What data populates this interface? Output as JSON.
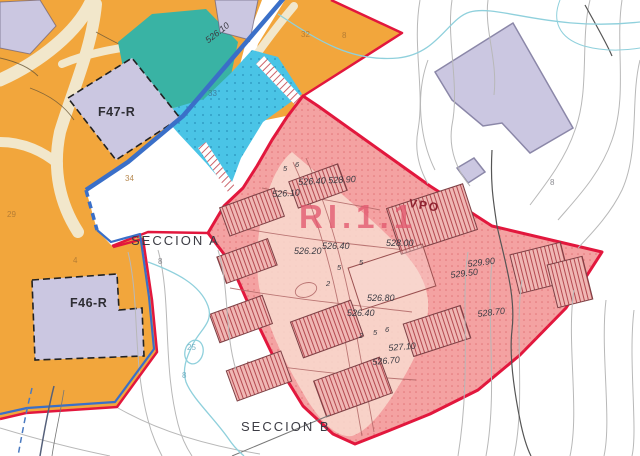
{
  "labels": {
    "f47": "F47-R",
    "f46": "F46-R",
    "sector": "RI.1.1",
    "vpo": "VPO",
    "seccion_a": "SECCION A",
    "seccion_b": "SECCION B"
  },
  "elevations": [
    "526.10",
    "526.40 528.90",
    "526.10",
    "528.00",
    "526.40",
    "526.20",
    "526.80",
    "526.40",
    "529.90",
    "529.50",
    "528.70",
    "527.10",
    "526.70"
  ],
  "road_widths": [
    "5",
    "6",
    "5",
    "5",
    "2",
    "2",
    "5",
    "6"
  ],
  "parcel_numbers": [
    "32",
    "8",
    "33",
    "34",
    "29",
    "4",
    "8",
    "25",
    "8",
    "8"
  ],
  "colors": {
    "orange_zone": "#F2A63C",
    "teal_zone": "#39B3A4",
    "blue_zone": "#4AC4E6",
    "pink_zone": "#F4A2A2",
    "pink_interior": "#F8DACF",
    "lavender_parcel": "#CBC7E1",
    "boundary_red": "#E2173D",
    "boundary_blue": "#3A6FC8"
  }
}
